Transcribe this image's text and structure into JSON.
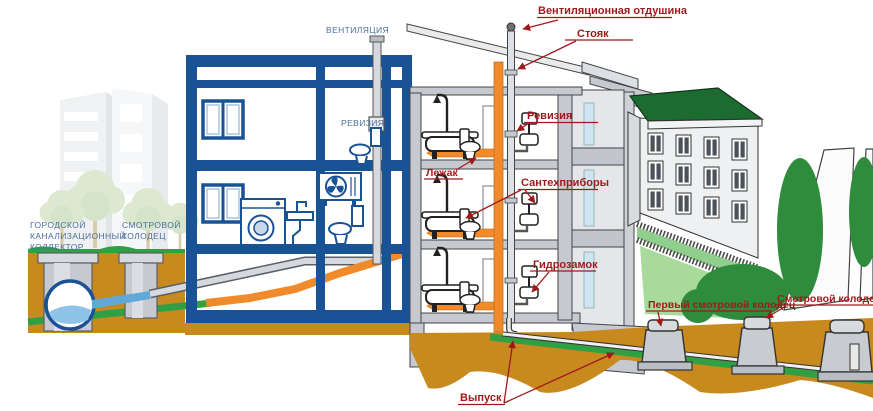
{
  "diagram": {
    "type": "building-sewerage-system-diagram",
    "schematic_labels": {
      "ventilation": "ВЕНТИЛЯЦИЯ",
      "revision": "РЕВИЗИЯ",
      "city_collector": [
        "ГОРОДСКОЙ",
        "КАНАЛИЗАЦИОННЫЙ",
        "КОЛЛЕКТОР"
      ],
      "inspection_well": [
        "СМОТРОВОЙ",
        "КОЛОДЕЦ"
      ]
    },
    "callout_labels": {
      "vent_outlet": "Вентиляционная отдушина",
      "riser": "Стояк",
      "revision": "Ревизия",
      "lying_pipe": "Лежак",
      "fixtures": "Сантехприборы",
      "water_trap": "Гидрозамок",
      "outlet": "Выпуск",
      "first_inspection_well": "Первый смотровой колодец",
      "inspection_well": "Смотровой колодец"
    },
    "colors": {
      "schematic_blue": "#1A5296",
      "schematic_label_blue": "#4C6F9C",
      "callout_red": "#9E1A1A",
      "sewer_pipe_orange": "#F08A2B",
      "soil_brown": "#C8891E",
      "grass_green": "#2FA044",
      "roof_green": "#1C6B30",
      "pipe_gray": "#D5D8DC",
      "water_blue": "#8FC3E8"
    }
  }
}
